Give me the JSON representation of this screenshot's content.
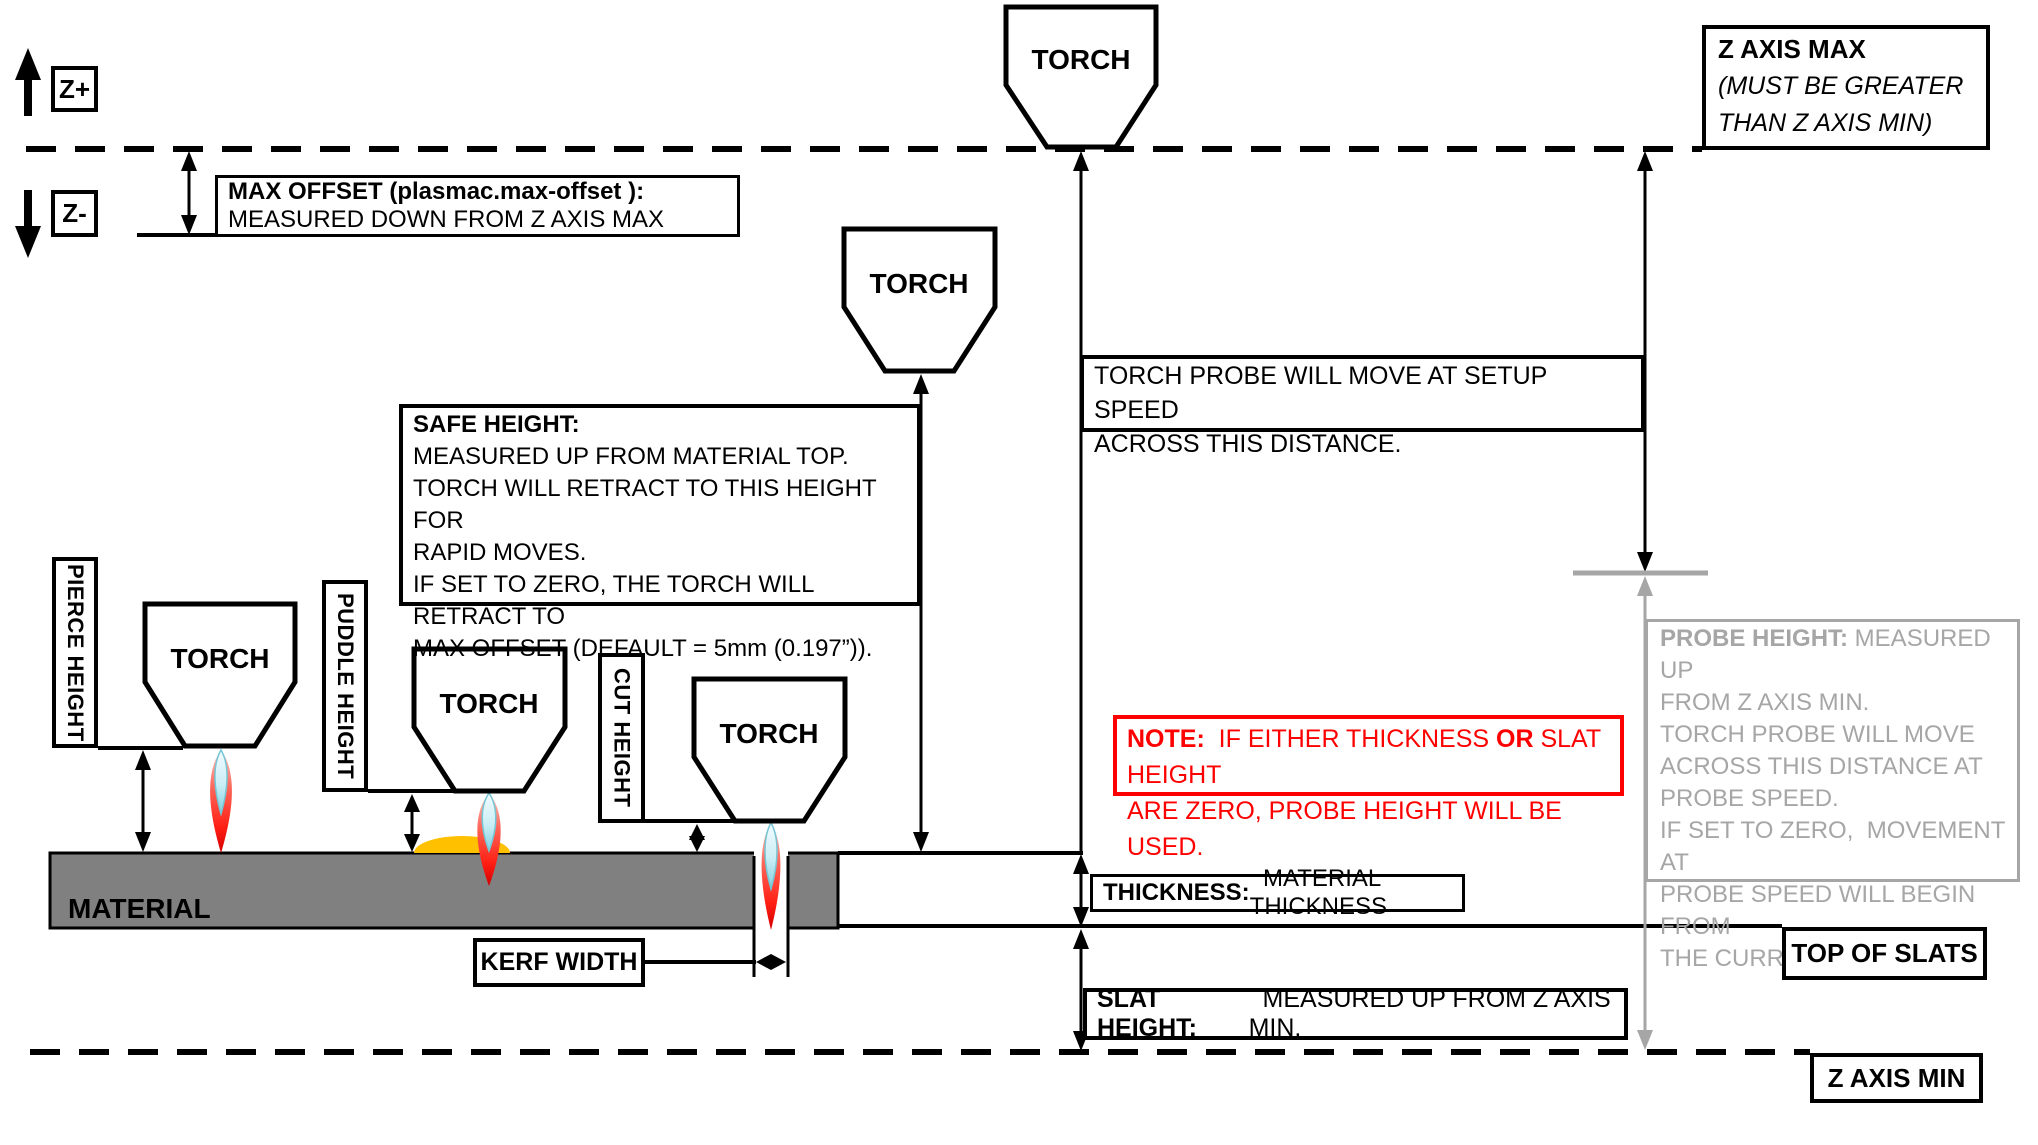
{
  "axis": {
    "z_plus": "Z+",
    "z_minus": "Z-",
    "z_axis_max_title": "Z AXIS MAX",
    "z_axis_max_note1": "(MUST BE GREATER",
    "z_axis_max_note2": "THAN Z AXIS MIN)",
    "z_axis_min": "Z AXIS MIN",
    "top_of_slats": "TOP OF SLATS"
  },
  "torch_label": "TORCH",
  "max_offset": {
    "title": "MAX OFFSET (plasmac.max-offset ):",
    "desc": "MEASURED DOWN FROM Z AXIS MAX"
  },
  "torch_probe": {
    "line1": "TORCH PROBE WILL MOVE AT SETUP SPEED",
    "line2": "ACROSS THIS DISTANCE."
  },
  "safe_height": {
    "title": "SAFE HEIGHT:",
    "lines": [
      "MEASURED UP FROM MATERIAL TOP.",
      "TORCH WILL RETRACT TO THIS HEIGHT FOR",
      "RAPID MOVES.",
      "IF SET TO ZERO, THE TORCH WILL RETRACT TO",
      "MAX OFFSET (DEFAULT = 5mm (0.197”))."
    ]
  },
  "height_labels": {
    "pierce": "PIERCE HEIGHT",
    "puddle": "PUDDLE HEIGHT",
    "cut": "CUT HEIGHT"
  },
  "material_label": "MATERIAL",
  "kerf_label": "KERF WIDTH",
  "note": {
    "bold1": "NOTE:",
    "seg1": "  IF EITHER THICKNESS ",
    "bold2": "OR",
    "seg2": " SLAT HEIGHT",
    "line2": "ARE ZERO, PROBE HEIGHT WILL BE USED."
  },
  "probe_height": {
    "title": "PROBE HEIGHT:",
    "title_rest": " MEASURED UP",
    "lines": [
      "FROM Z AXIS MIN.",
      "TORCH PROBE WILL MOVE",
      "ACROSS THIS DISTANCE AT",
      "PROBE SPEED.",
      "IF SET TO ZERO,  MOVEMENT AT",
      "PROBE SPEED WILL BEGIN FROM",
      "THE CURRENT POSITION."
    ]
  },
  "thickness": {
    "title": "THICKNESS:",
    "desc": "  MATERIAL THICKNESS"
  },
  "slat_height": {
    "title": "SLAT HEIGHT:",
    "desc": "  MEASURED UP FROM Z AXIS MIN."
  },
  "colors": {
    "line_black": "#000000",
    "measure_gray": "#a6a6a6",
    "material_gray": "#808080",
    "note_red": "#ff0000",
    "puddle_orange": "#ffc000",
    "flame_red": "#ff1f14",
    "flame_cyan": "#9adbe8"
  }
}
